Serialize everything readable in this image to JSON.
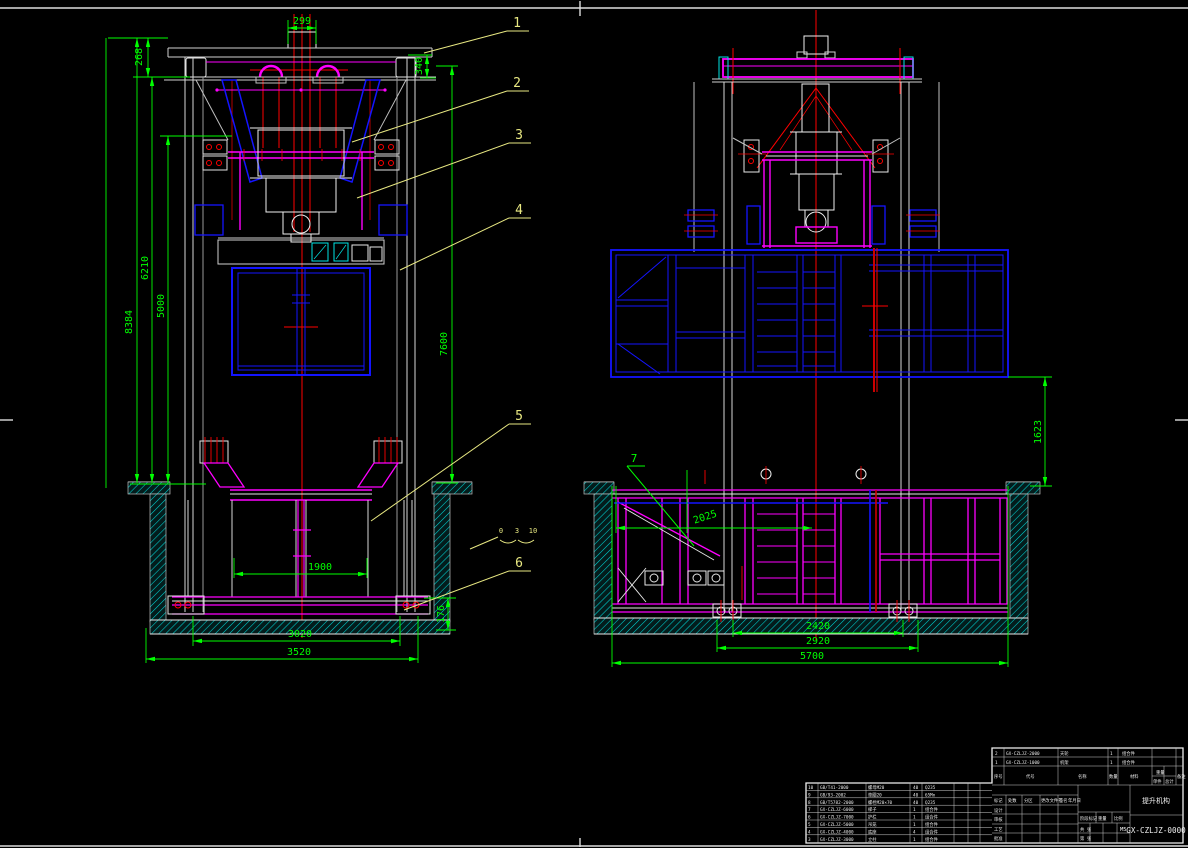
{
  "drawing": {
    "number": "GX-CZLJZ-0000",
    "name": "提升机构",
    "scale_value": "M5"
  },
  "colors": {
    "dim": "#00ff00",
    "structure_white": "#e8e8e8",
    "magenta": "#ff00ff",
    "blue": "#1414ff",
    "red": "#ff0000",
    "cyan": "#00e5e5",
    "balloon_yellow": "#e8e882",
    "background": "#000000"
  },
  "dims": {
    "left": {
      "d299": "299",
      "d268": "268",
      "d340": "340",
      "d8384": "8384",
      "d6210": "6210",
      "d5000": "5000",
      "d7600": "7600",
      "d1900": "1900",
      "d176": "176",
      "d3020": "3020",
      "d3520": "3520"
    },
    "right": {
      "d1623": "1623",
      "d2025": "2025",
      "d2420": "2420",
      "d2920": "2920",
      "d5700": "5700"
    }
  },
  "balloons": {
    "b1": "1",
    "b2": "2",
    "b3": "3",
    "b4": "4",
    "b5": "5",
    "b6": "6",
    "b7": "7"
  },
  "weld_note": {
    "m0": "0",
    "m1": "3",
    "m2": "10"
  },
  "bom_a": {
    "rows": [
      {
        "seq": "10",
        "code": "GB/T41-2000",
        "name": "螺母M20",
        "qty": "40",
        "mat": "Q235"
      },
      {
        "seq": "9",
        "code": "GB/93-2002",
        "name": "垫圈20",
        "qty": "40",
        "mat": "65Mn"
      },
      {
        "seq": "8",
        "code": "GB/T5782-2000",
        "name": "螺栓M20×70",
        "qty": "40",
        "mat": "Q235"
      },
      {
        "seq": "7",
        "code": "GX-CZLJZ-6000",
        "name": "梯子",
        "qty": "1",
        "mat": "组合件"
      },
      {
        "seq": "6",
        "code": "GX-CZLJZ-7000",
        "name": "护栏",
        "qty": "1",
        "mat": "组合件"
      },
      {
        "seq": "5",
        "code": "GX-CZLJZ-5000",
        "name": "吊笼",
        "qty": "1",
        "mat": "组合件"
      },
      {
        "seq": "4",
        "code": "GX-CZLJZ-4000",
        "name": "底座",
        "qty": "4",
        "mat": "组合件"
      },
      {
        "seq": "3",
        "code": "GX-CZLJZ-3000",
        "name": "立柱",
        "qty": "1",
        "mat": "组合件"
      }
    ]
  },
  "bom_b": {
    "rows": [
      {
        "seq": "2",
        "code": "GX-CZLJZ-2000",
        "name": "天轮",
        "qty": "1",
        "mat": "组合件"
      },
      {
        "seq": "1",
        "code": "GX-CZLJZ-1000",
        "name": "机架",
        "qty": "1",
        "mat": "组合件"
      }
    ],
    "headers": {
      "seq": "序号",
      "code": "代号",
      "name": "名称",
      "qty": "数量",
      "mat": "材料",
      "weight": "重量",
      "unit": "单件",
      "total": "总计",
      "note": "备注"
    }
  },
  "title_block": {
    "mark_row": [
      "标记",
      "处数",
      "分区",
      "更改文件号",
      "签名",
      "年月日"
    ],
    "sign_rows": [
      "设计",
      "审核",
      "工艺",
      "批准"
    ],
    "stage_label": "阶段标记",
    "weight_label": "重量",
    "scale_label": "比例",
    "sheets_label": "共 张",
    "page_label": "第 张"
  }
}
